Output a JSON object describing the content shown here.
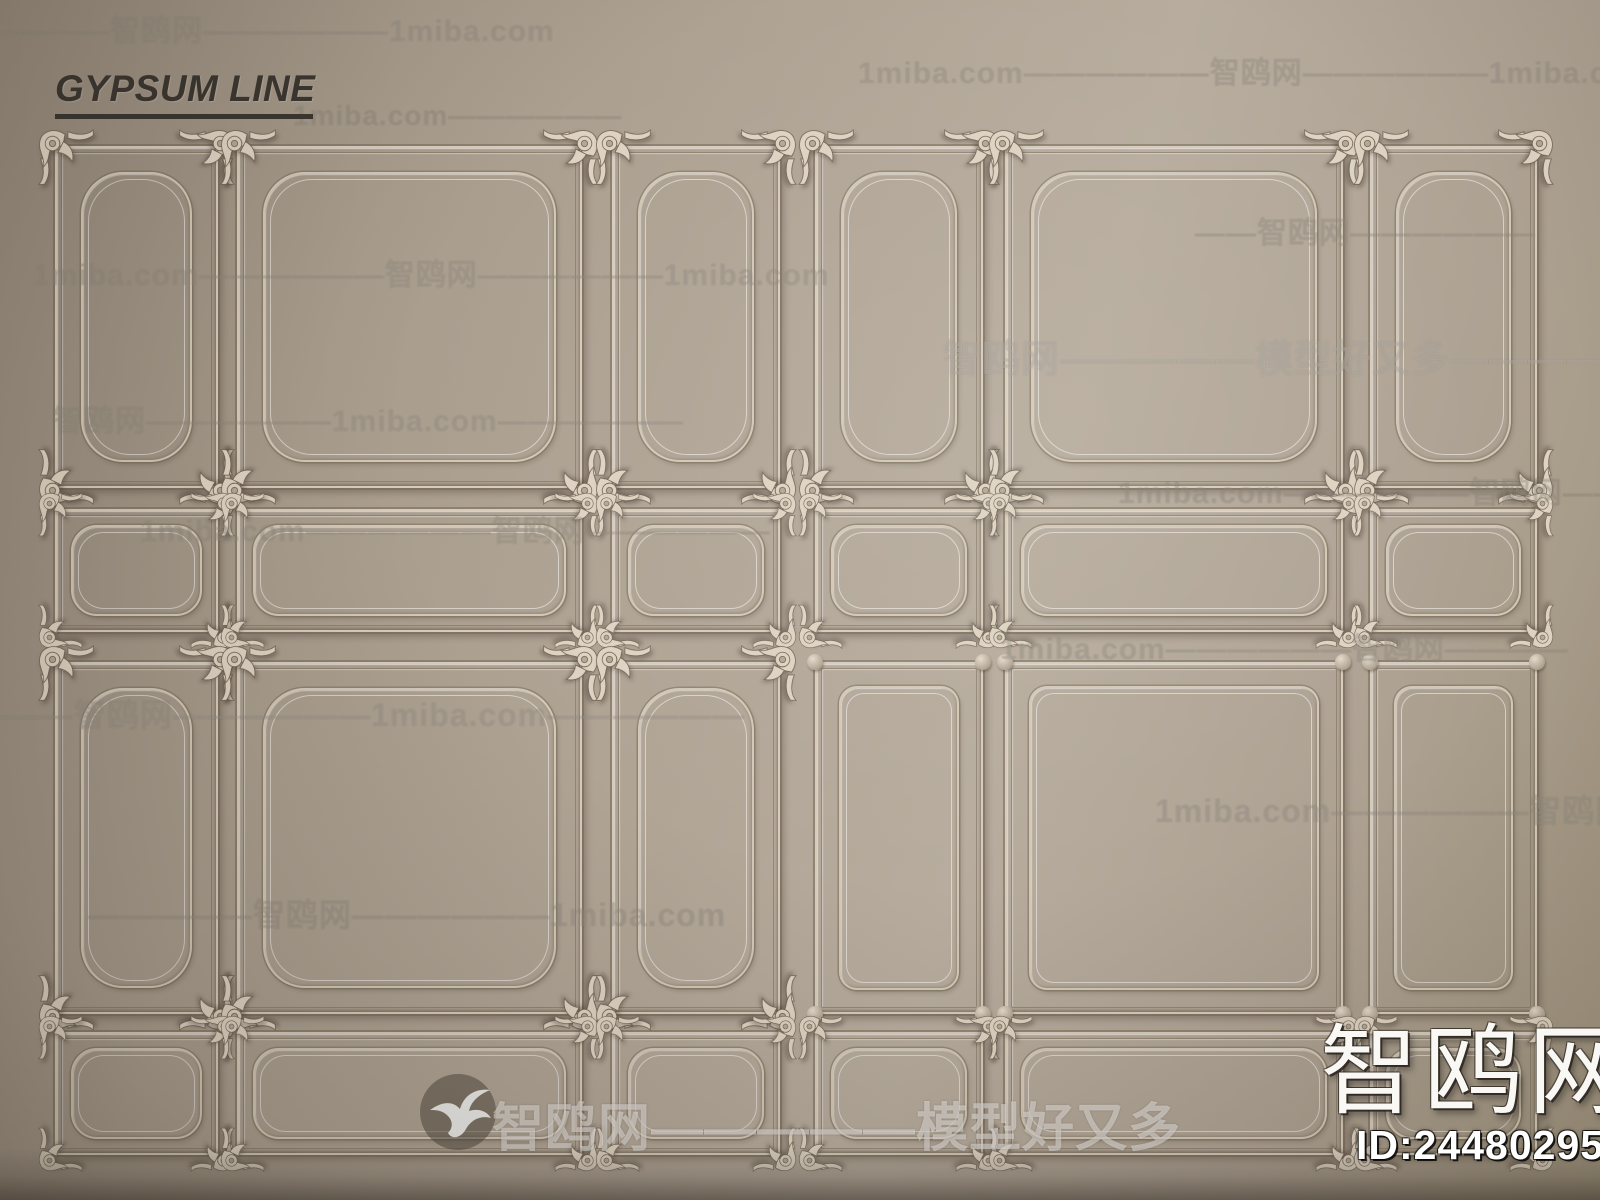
{
  "header": {
    "title": "GYPSUM LINE"
  },
  "watermarks": {
    "rows": [
      {
        "x": -45,
        "y": 6,
        "size": 30,
        "opacity": 0.13,
        "text": "—————智鸥网——————1miba.com"
      },
      {
        "x": 858,
        "y": 48,
        "size": 30,
        "opacity": 0.13,
        "text": "1miba.com——————智鸥网——————1miba.com"
      },
      {
        "x": 293,
        "y": 100,
        "size": 28,
        "opacity": 0.11,
        "text": "1miba.com——————"
      },
      {
        "x": 1195,
        "y": 208,
        "size": 30,
        "opacity": 0.12,
        "text": "——智鸥网——————"
      },
      {
        "x": 33,
        "y": 250,
        "size": 30,
        "opacity": 0.13,
        "text": "1miba.com——————智鸥网——————1miba.com"
      },
      {
        "x": 943,
        "y": 328,
        "size": 38,
        "opacity": 0.22,
        "text": "智鸥网—————模型好又多——————"
      },
      {
        "x": 53,
        "y": 396,
        "size": 30,
        "opacity": 0.13,
        "text": "智鸥网——————1miba.com——————"
      },
      {
        "x": 1118,
        "y": 468,
        "size": 30,
        "opacity": 0.11,
        "text": "1miba.com——————智鸥网——"
      },
      {
        "x": 140,
        "y": 506,
        "size": 30,
        "opacity": 0.13,
        "text": "1miba.com——————智鸥网——————"
      },
      {
        "x": 1000,
        "y": 624,
        "size": 30,
        "opacity": 0.13,
        "text": "1miba.com——————智鸥网————"
      },
      {
        "x": -25,
        "y": 690,
        "size": 32,
        "opacity": 0.14,
        "text": "———智鸥网——————1miba.com——————"
      },
      {
        "x": 1155,
        "y": 786,
        "size": 32,
        "opacity": 0.13,
        "text": "1miba.com——————智鸥网——————"
      },
      {
        "x": 88,
        "y": 890,
        "size": 32,
        "opacity": 0.13,
        "text": "—————智鸥网——————1miba.com"
      }
    ]
  },
  "footer": {
    "banner_text": "智鸥网—————模型好又多"
  },
  "badge": {
    "logo_text": "智鸥网",
    "id_text": "ID:244802957"
  },
  "colors": {
    "wall_light": "#b7ac9d",
    "wall_mid": "#aba090",
    "wall_dark": "#94887a",
    "molding_light": "#d7ccbb",
    "molding_shadow": "#766856",
    "title_ink": "#3a352f",
    "watermark": "#ffffff"
  },
  "scene": {
    "cols": [
      {
        "x": 55,
        "w": 163
      },
      {
        "x": 237,
        "w": 345
      },
      {
        "x": 612,
        "w": 168
      },
      {
        "x": 815,
        "w": 168
      },
      {
        "x": 1005,
        "w": 338
      },
      {
        "x": 1370,
        "w": 167
      }
    ],
    "rows": [
      {
        "y": 146,
        "h": 342
      },
      {
        "y": 509,
        "h": 123
      },
      {
        "y": 662,
        "h": 352
      },
      {
        "y": 1032,
        "h": 123
      }
    ],
    "style_grid": [
      [
        "ornate",
        "ornate",
        "ornate",
        "ornate",
        "ornate",
        "ornate"
      ],
      [
        "ornate",
        "ornate",
        "ornate",
        "ornate",
        "ornate",
        "ornate"
      ],
      [
        "ornate",
        "ornate",
        "ornate",
        "plain",
        "plain",
        "plain"
      ],
      [
        "ornate",
        "ornate",
        "ornate",
        "ornate",
        "ornate",
        "ornate"
      ]
    ]
  }
}
